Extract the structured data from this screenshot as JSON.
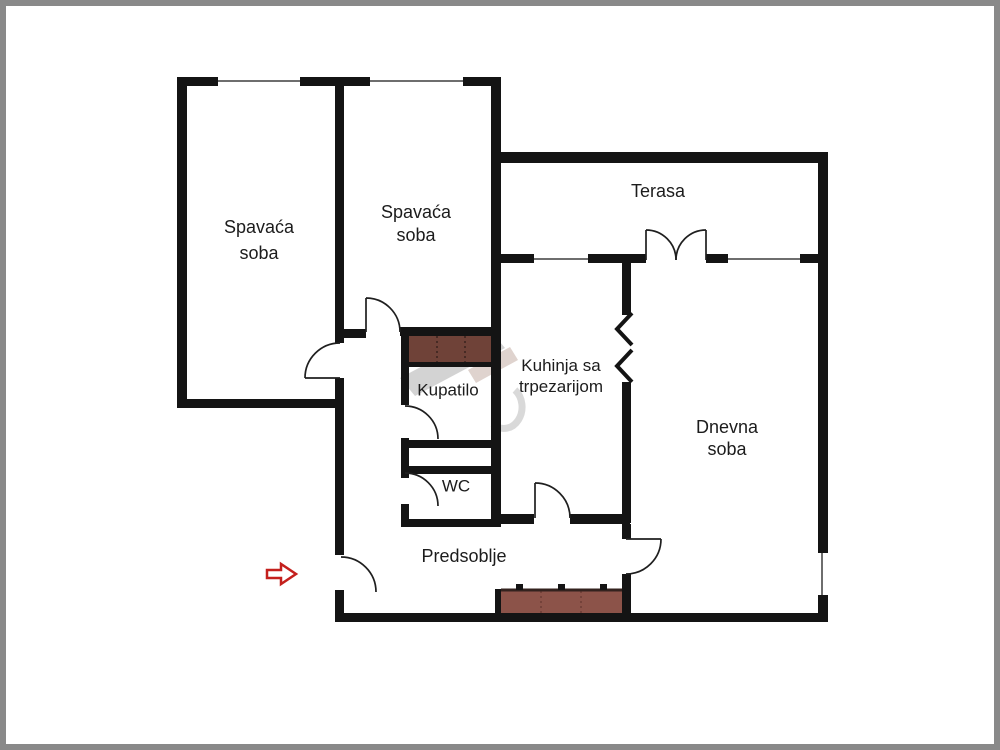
{
  "plan": {
    "type": "apartment-floor-plan",
    "labels": {
      "bedroom1_line1": "Spavaća",
      "bedroom1_line2": "soba",
      "bedroom2_line1": "Spavaća",
      "bedroom2_line2": "soba",
      "terrace": "Terasa",
      "bathroom": "Kupatilo",
      "kitchen_line1": "Kuhinja sa",
      "kitchen_line2": "trpezarijom",
      "wc": "WC",
      "living_line1": "Dnevna",
      "living_line2": "soba",
      "hallway": "Predsoblje"
    },
    "colors": {
      "wall": "#141414",
      "frame_border": "#898989",
      "wardrobe_fill": "#6f4238",
      "closet_fill": "#8c5349",
      "closet_top_border": "#33221e",
      "entrance_arrow": "#c4201d",
      "window_line": "#6e6e6e",
      "watermark_gray": "#a8a8a8"
    },
    "icons": {
      "entrance_arrow": "right-arrow-icon",
      "wall_break": "passage-break-chevrons"
    }
  }
}
